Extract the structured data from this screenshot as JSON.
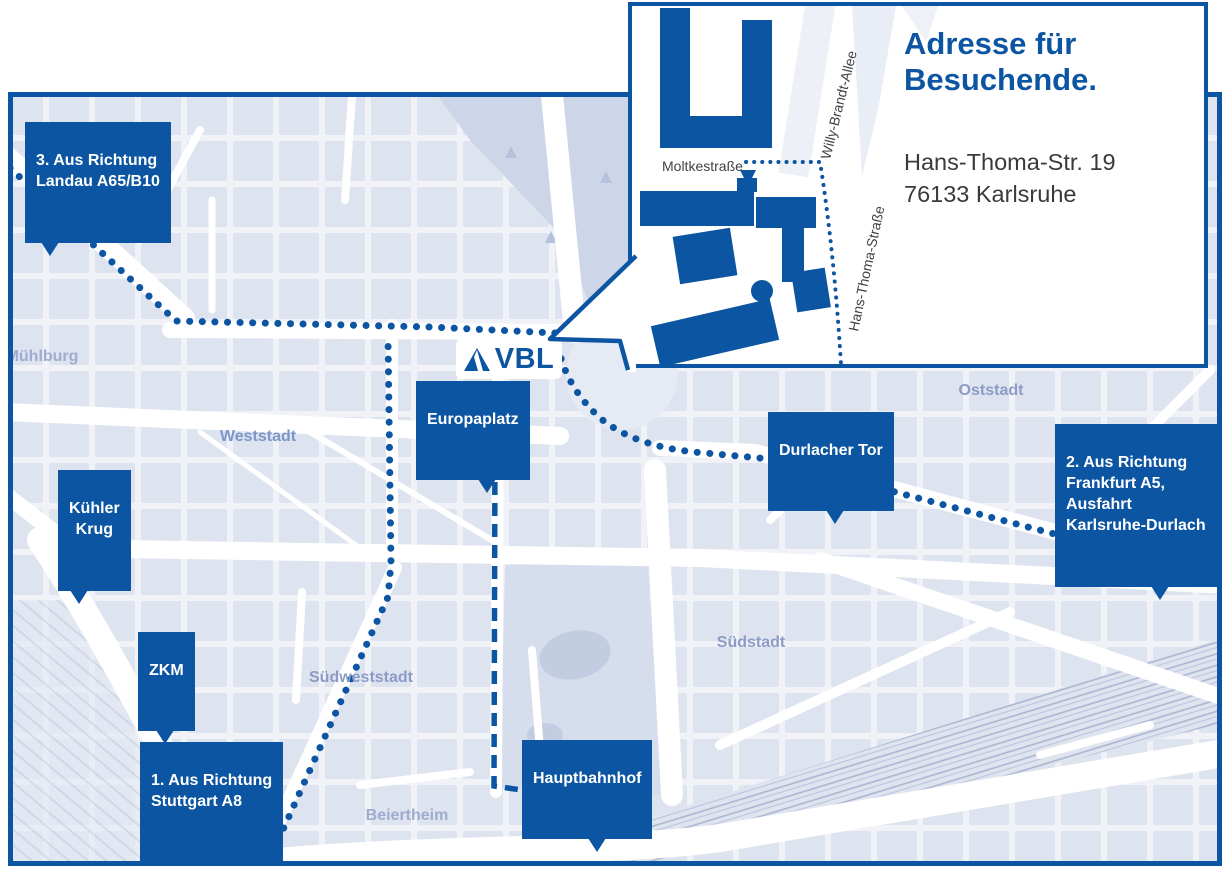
{
  "colors": {
    "brand_blue": "#0c55a2",
    "map_background": "#f0f2f8",
    "city_block": "#dde3ef",
    "park": "#cdd6e8",
    "district_label": "#8c9cc6",
    "street_label_dark": "#3f4247",
    "street_label_blue": "#7288bd"
  },
  "logo": {
    "text": "VBL"
  },
  "inset": {
    "heading": "Adresse für\nBesuchende.",
    "address": "Hans-Thoma-Str. 19\n76133 Karlsruhe",
    "streets": {
      "moltkestrasse": "Moltkestraße",
      "willy_brandt_allee": "Willy-Brandt-Allee",
      "hans_thoma_strasse": "Hans-Thoma-Straße"
    }
  },
  "map": {
    "callouts": {
      "landau": "3. Aus Richtung\nLandau A65/B10",
      "frankfurt": "2. Aus Richtung\nFrankfurt A5,\nAusfahrt\nKarlsruhe-Durlach",
      "stuttgart": "1. Aus Richtung\nStuttgart A8",
      "kuehler_krug": "Kühler\nKrug",
      "zkm": "ZKM",
      "europaplatz": "Europaplatz",
      "durlacher_tor": "Durlacher Tor",
      "hauptbahnhof": "Hauptbahnhof"
    },
    "districts": {
      "muehlburg": "Mühlburg",
      "weststadt": "Weststadt",
      "suedweststadt": "Südweststadt",
      "suedstadt": "Südstadt",
      "oststadt": "Oststadt",
      "beiertheim": "Beiertheim"
    },
    "streets": {
      "siemensallee": "Siemensallee",
      "kussmaulstrasse": "Kußmaulstraße",
      "franz_lust_strasse": "Franz-Lust-Straße",
      "erzbergerstrasse": "Erzbergerstraße",
      "moltkestrasse": "Moltkestraße",
      "willy_brandt_allee": "Willy-Brandt-Allee",
      "adenauerring": "Adenauerring",
      "kaiserallee": "Kaiserallee",
      "reinhold_frank_strasse": "Reinhold-Frank-Straße",
      "kriegstrasse": "Kriegstraße",
      "kriegstrasse_b10": "Kriegstraße B10",
      "karlstrasse": "Karlstraße",
      "ettlinger_strasse": "Ettlinger Straße",
      "beiertheimer_allee": "Beiertheimer Allee",
      "kapellenstrasse": "Kapellenstraße",
      "durlacher_allee": "Durlacher Allee",
      "b10_mid": "B10",
      "b10_southeast": "B10",
      "ostring": "Ostring",
      "landau_b10": "◀ Landau B10",
      "suedtangente_west": "Südtangente",
      "suedtangente_sued": "Südtangente",
      "alb": "Alb",
      "steinhaeuserstrasse": "Steinhäuserstraße",
      "brauerstrasse": "Brauerstraße",
      "ebertstrasse": "Ebertstraße",
      "stuttgarter_strasse": "Stuttgarter Straße",
      "ottostrasse": "Ottostraße",
      "pulverhausstrasse": "Pulverhausstraße"
    }
  }
}
